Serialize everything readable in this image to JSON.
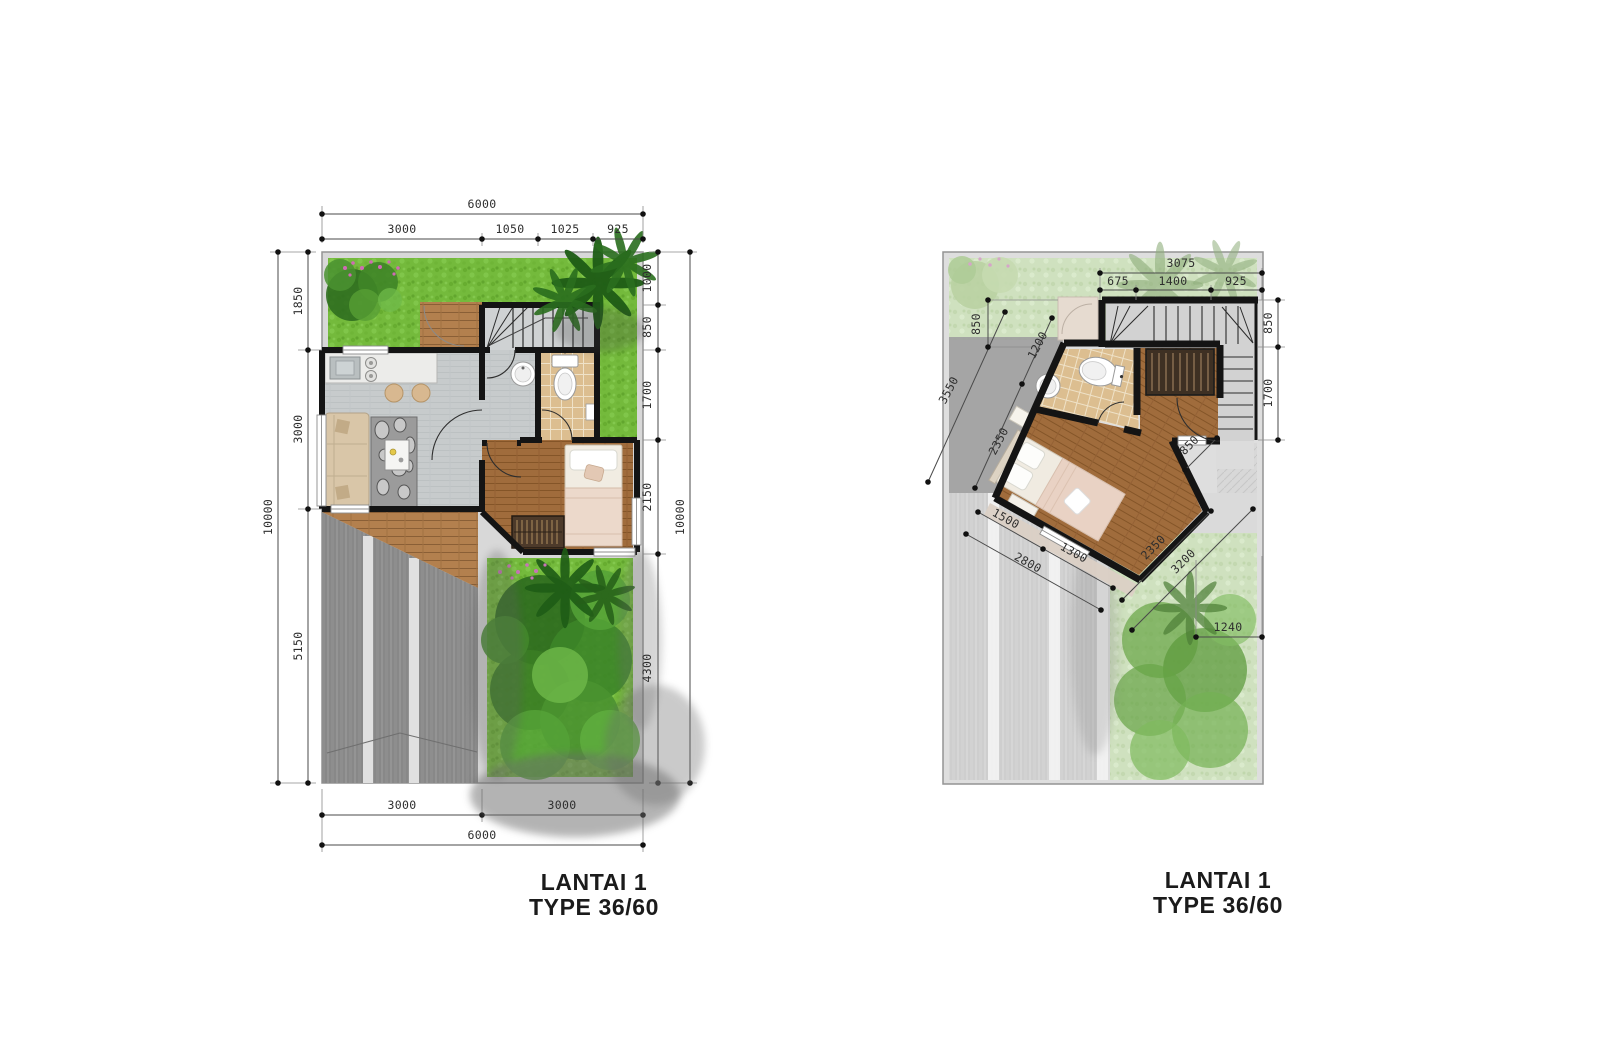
{
  "document": {
    "type_label": "TYPE 36/60",
    "floor_label": "LANTAI 1"
  },
  "colors": {
    "grass": "#74ba3c",
    "grass_faded": "#cfe1bf",
    "wall": "#141414",
    "driveway": "#8e8e8e",
    "driveway_faded": "#d2d2d2",
    "wood_deck": "#b3804e",
    "wood_floor": "#a06c3c",
    "bath_tile": "#dcbe90",
    "interior_floor": "#c7cbcc",
    "dim_text": "#2e2e2e",
    "title_text": "#1b1b1b"
  },
  "lp": {
    "title1": "LANTAI 1",
    "title2": "TYPE 36/60",
    "top_total": "6000",
    "top_seg": [
      "3000",
      "1050",
      "1025",
      "925"
    ],
    "left_total": "10000",
    "left_seg": [
      "1850",
      "3000",
      "5150"
    ],
    "right_total": "10000",
    "right_seg": [
      "1000",
      "850",
      "1700",
      "2150",
      "4300"
    ],
    "bottom_seg": [
      "3000",
      "3000"
    ],
    "bottom_total": "6000"
  },
  "rp": {
    "title1": "LANTAI 1",
    "title2": "TYPE 36/60",
    "top_total": "3075",
    "top_seg": [
      "675",
      "1400",
      "925"
    ],
    "right_seg": [
      "850",
      "1700"
    ],
    "left_v": "850",
    "left_diag": [
      "1200",
      "3550",
      "2350"
    ],
    "bl_diag": [
      "1500",
      "2800",
      "1300"
    ],
    "br_diag": [
      "850",
      "2350",
      "3200"
    ],
    "br_h": "1240"
  }
}
